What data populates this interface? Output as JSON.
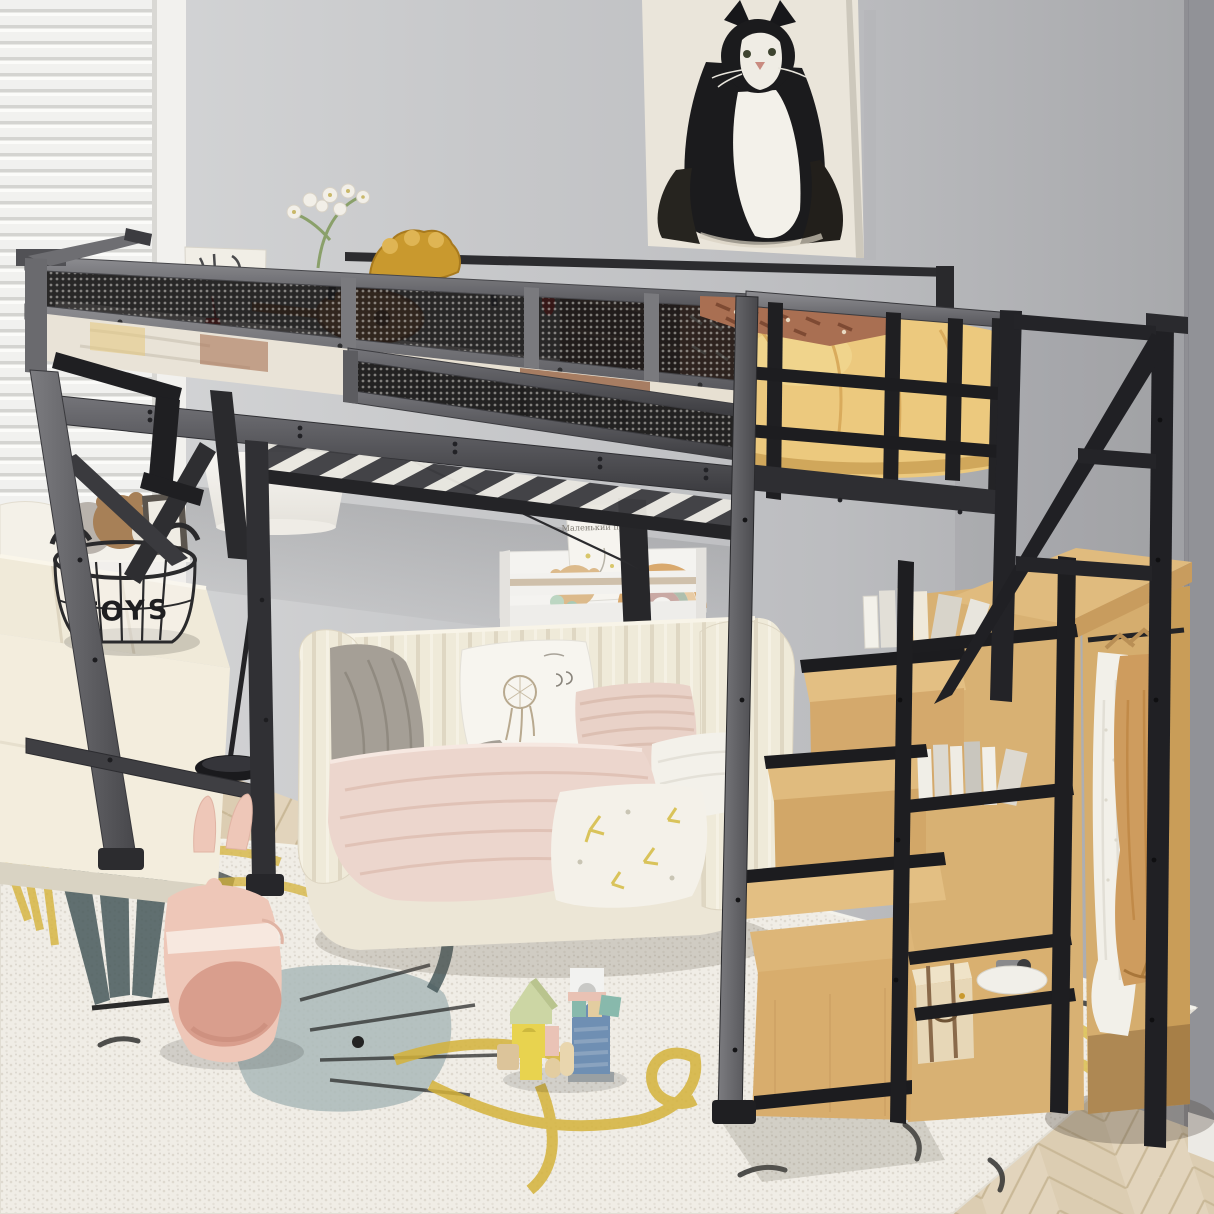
{
  "meta": {
    "domain": "Natural-Image",
    "description": "Product photograph of a black metal full-size loft bed with mesh guardrails above a cream channel-tufted daybed sofa; on the right a wooden storage staircase with bookshelves and an open wardrobe with hanging clothes; gray walls, venetian blinds, cat painting, white wall shelf with toys, floor lamp, wire toy basket, plush bunny tunnel, building blocks and a patterned rug on herringbone wood flooring."
  },
  "texts": {
    "toy_basket_label": "TOYS",
    "book_title": "Маленький принц"
  },
  "palette": {
    "wall": "#c7c8ca",
    "wall_right": "#919297",
    "bed_frame_lit": "#828286",
    "bed_frame_dark": "#232326",
    "mesh": "#1c1c1f",
    "mattress_yellow": "#ecc97e",
    "blanket_terracotta": "#a96f52",
    "stair_wood": "#ddb678",
    "wardrobe_wood": "#d5ad6e",
    "sofa_cream": "#efead9",
    "throw_gray": "#a59f96",
    "blanket_pink": "#ecd6cd",
    "rug_base": "#f0ede6",
    "rug_yellow": "#d4b23a",
    "rug_teal": "#46585a",
    "floor_wood": "#e2d4bc",
    "garment_white": "#f2f0e9",
    "garment_tan": "#ce9c5e",
    "lamp_shade": "#f7f5f1",
    "bunny_pink": "#eec7b8"
  },
  "objects": [
    "venetian-blinds",
    "window-frame",
    "cat-painting",
    "gray-wall",
    "baseboard",
    "herringbone-floor",
    "patterned-rug",
    "window-bench",
    "toy-basket",
    "floor-lamp",
    "wall-shelf",
    "picture-book",
    "rainbow-toy",
    "gear-toy",
    "daybed-sofa",
    "dreamcatcher-pillow",
    "striped-pillow",
    "gray-throw",
    "pink-blanket",
    "loft-bed-frame",
    "mesh-guardrail",
    "bed-slats",
    "yellow-mattress",
    "patterned-blanket",
    "orchid",
    "gold-ornament",
    "white-card",
    "ukulele-toy",
    "storage-staircase",
    "stair-treads",
    "bookshelf-books",
    "storage-trunk",
    "white-bowl",
    "open-wardrobe",
    "hanging-clothes",
    "building-blocks",
    "plush-bunny-tunnel"
  ]
}
